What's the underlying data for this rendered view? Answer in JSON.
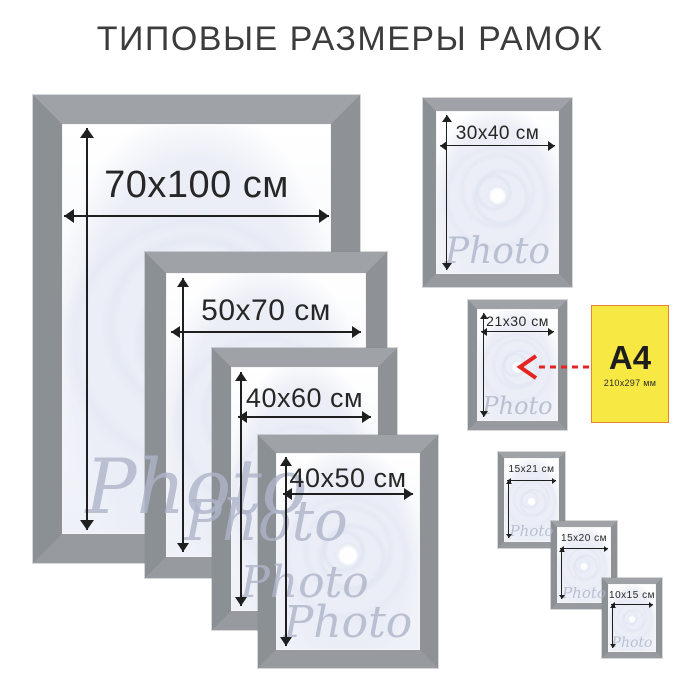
{
  "title": "ТИПОВЫЕ РАЗМЕРЫ РАМОК",
  "watermark_text": "Photo",
  "frames": [
    {
      "id": "70x100",
      "label": "70x100 см"
    },
    {
      "id": "50x70",
      "label": "50x70 см"
    },
    {
      "id": "40x60",
      "label": "40x60 см"
    },
    {
      "id": "40x50",
      "label": "40x50 см"
    },
    {
      "id": "30x40",
      "label": "30x40 см"
    },
    {
      "id": "21x30",
      "label": "21x30 см"
    },
    {
      "id": "15x21",
      "label": "15x21 см"
    },
    {
      "id": "15x20",
      "label": "15x20 см"
    },
    {
      "id": "10x15",
      "label": "10x15 см"
    }
  ],
  "a4_card": {
    "label": "A4",
    "size_note": "210x297 мм",
    "arrow_icon": "red-dashed-arrow-left"
  },
  "colors": {
    "frame_gray": "#94989c",
    "frame_top_bevel": "#9fa3a7",
    "paper_yellow": "#f8e843",
    "paper_border_orange": "#ee8030",
    "arrow_red": "#e32421",
    "dimension_line": "#1f1f1f",
    "title_text": "#3c3c3c",
    "watermark_gray": "#aeb5c9"
  }
}
